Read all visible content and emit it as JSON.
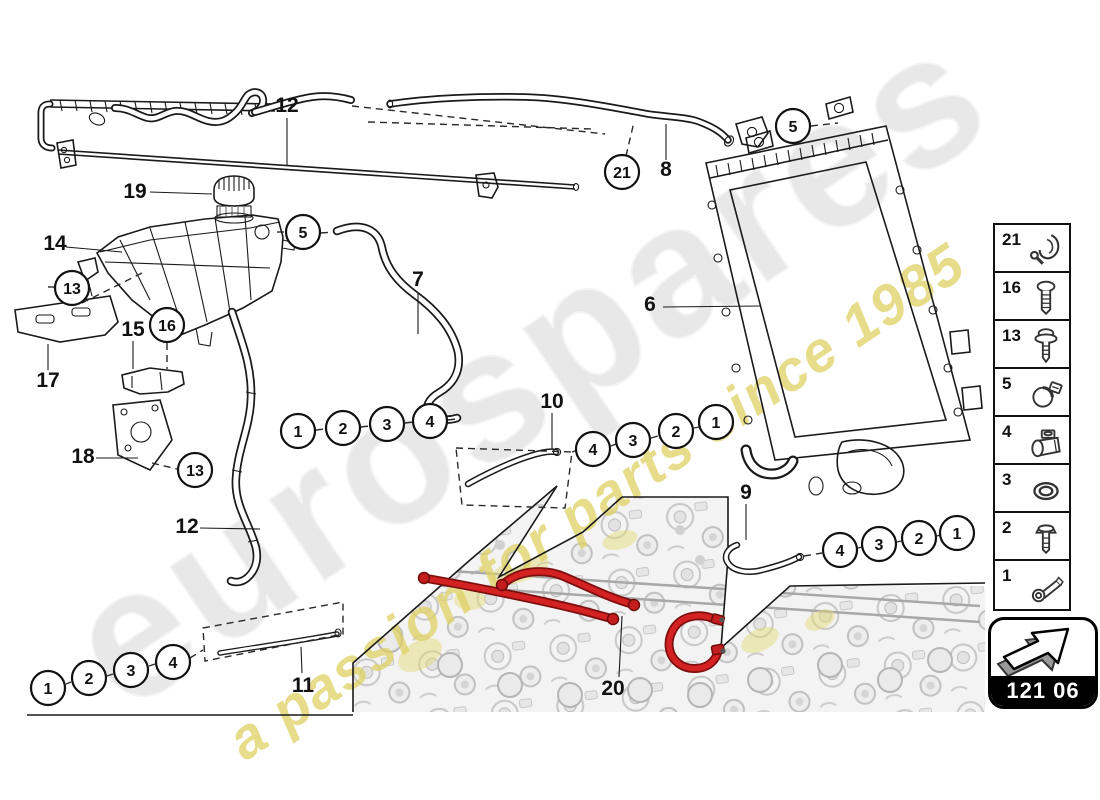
{
  "watermark": {
    "brand": "eurospares",
    "tagline": "a passion for parts since 1985"
  },
  "colors": {
    "highlight_hose_red": "#d42222",
    "watermark_gray": "#e4e4e4",
    "watermark_yellow": "#ddd061",
    "line_art": "#1a1a1a"
  },
  "code_box": {
    "code": "121 06",
    "icon": "direction-arrow"
  },
  "sidebar": {
    "items": [
      {
        "number": "21",
        "icon": "retainer-clip-icon"
      },
      {
        "number": "16",
        "icon": "screw-icon"
      },
      {
        "number": "13",
        "icon": "screw-washer-icon"
      },
      {
        "number": "5",
        "icon": "hose-clamp-icon"
      },
      {
        "number": "4",
        "icon": "pipe-clip-icon"
      },
      {
        "number": "3",
        "icon": "seal-ring-icon"
      },
      {
        "number": "2",
        "icon": "bolt-icon"
      },
      {
        "number": "1",
        "icon": "banjo-bolt-icon"
      }
    ]
  },
  "diagram": {
    "callouts": [
      {
        "n": "5"
      },
      {
        "n": "13"
      },
      {
        "n": "16"
      },
      {
        "n": "13"
      },
      {
        "n": "21"
      },
      {
        "n": "5"
      },
      {
        "n": "1"
      },
      {
        "n": "2"
      },
      {
        "n": "3"
      },
      {
        "n": "4"
      },
      {
        "n": "4"
      },
      {
        "n": "3"
      },
      {
        "n": "2"
      },
      {
        "n": "1"
      },
      {
        "n": "4"
      },
      {
        "n": "3"
      },
      {
        "n": "2"
      },
      {
        "n": "1"
      },
      {
        "n": "1"
      },
      {
        "n": "2"
      },
      {
        "n": "3"
      },
      {
        "n": "4"
      }
    ],
    "part_labels": [
      {
        "t": "12"
      },
      {
        "t": "19"
      },
      {
        "t": "14"
      },
      {
        "t": "7"
      },
      {
        "t": "8"
      },
      {
        "t": "6"
      },
      {
        "t": "17"
      },
      {
        "t": "15"
      },
      {
        "t": "18"
      },
      {
        "t": "12"
      },
      {
        "t": "10"
      },
      {
        "t": "9"
      },
      {
        "t": "11"
      },
      {
        "t": "20"
      }
    ]
  }
}
